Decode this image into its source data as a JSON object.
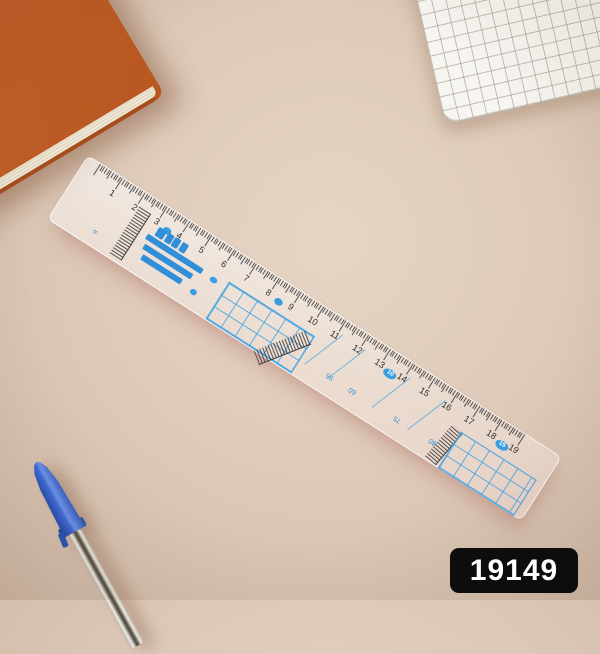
{
  "photo": {
    "background_color": "#dcc8b7"
  },
  "badge": {
    "text": "19149",
    "bg": "#0d0d0d",
    "fg": "#ffffff"
  },
  "ruler": {
    "accent_color": "#35a0e2",
    "tick_color": "#3a3a3a",
    "cm_numbers": [
      "1",
      "2",
      "3",
      "4",
      "5",
      "6",
      "7",
      "8",
      "9",
      "10",
      "11",
      "12",
      "13",
      "14",
      "15",
      "16",
      "17",
      "18",
      "19"
    ],
    "unit_ovals": [
      {
        "cm": 3.5,
        "label": ""
      },
      {
        "cm": 8.5,
        "label": ""
      },
      {
        "cm": 13.5,
        "label": "10"
      },
      {
        "cm": 18.5,
        "label": "15"
      }
    ],
    "conversion_marks": [
      {
        "cm": 11.2,
        "label": "55"
      },
      {
        "cm": 12.2,
        "label": "60"
      },
      {
        "cm": 14.2,
        "label": "75"
      },
      {
        "cm": 15.8,
        "label": "80"
      }
    ]
  },
  "objects": {
    "notebook": {
      "color": "#c8632c",
      "pages_color": "#eee6d4"
    },
    "notepad": {
      "paper_color": "#f7f5f0",
      "grid_color": "#96908a"
    },
    "pen": {
      "cap_color": "#2d55bd"
    }
  }
}
